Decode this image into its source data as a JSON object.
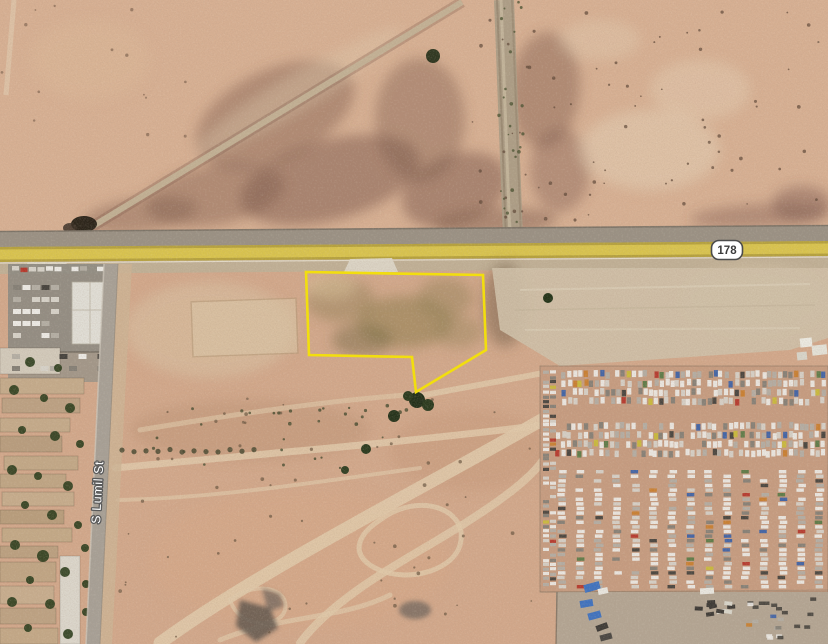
{
  "map": {
    "view_type": "satellite-hybrid",
    "description": "Aerial view of desert parcel along highway 178 with auto salvage yard"
  },
  "labels": {
    "route_shield": "178",
    "street_name": "S Lumil St"
  },
  "parcel": {
    "points": "306,272 483,275 486,350 416,392 412,357 309,355",
    "outline_color": "#f2de0e"
  },
  "colors": {
    "desert_north": "#d7b093",
    "desert_south": "#d2a88b",
    "scrub_dark": "#7a584a",
    "highway_yellow": "#d9c44e",
    "pavement_gray": "#9a9184",
    "shoulder_tan": "#c0b096",
    "graded_pad": "#cec0a8",
    "junkyard_dirt": "#c69c80",
    "asphalt": "#918c83",
    "roof_white": "#e0ded6",
    "tree_green": "#2e3f1e",
    "track_light": "#e0c9aa",
    "shield_bg": "#ffffff",
    "shield_border": "#4c4c4c",
    "shield_text": "#3c3c3c",
    "street_label_fill": "#ffffff",
    "street_label_halo": "#5a5a5a"
  },
  "junkyard": {
    "car_palette": [
      "#eceae5",
      "#d6d2c9",
      "#b3aea4",
      "#847f76",
      "#45423d",
      "#b5372b",
      "#c97e2e",
      "#3c62a8",
      "#c9bb3a",
      "#5a7a46"
    ],
    "tarp_blue": "#3f72bf"
  }
}
